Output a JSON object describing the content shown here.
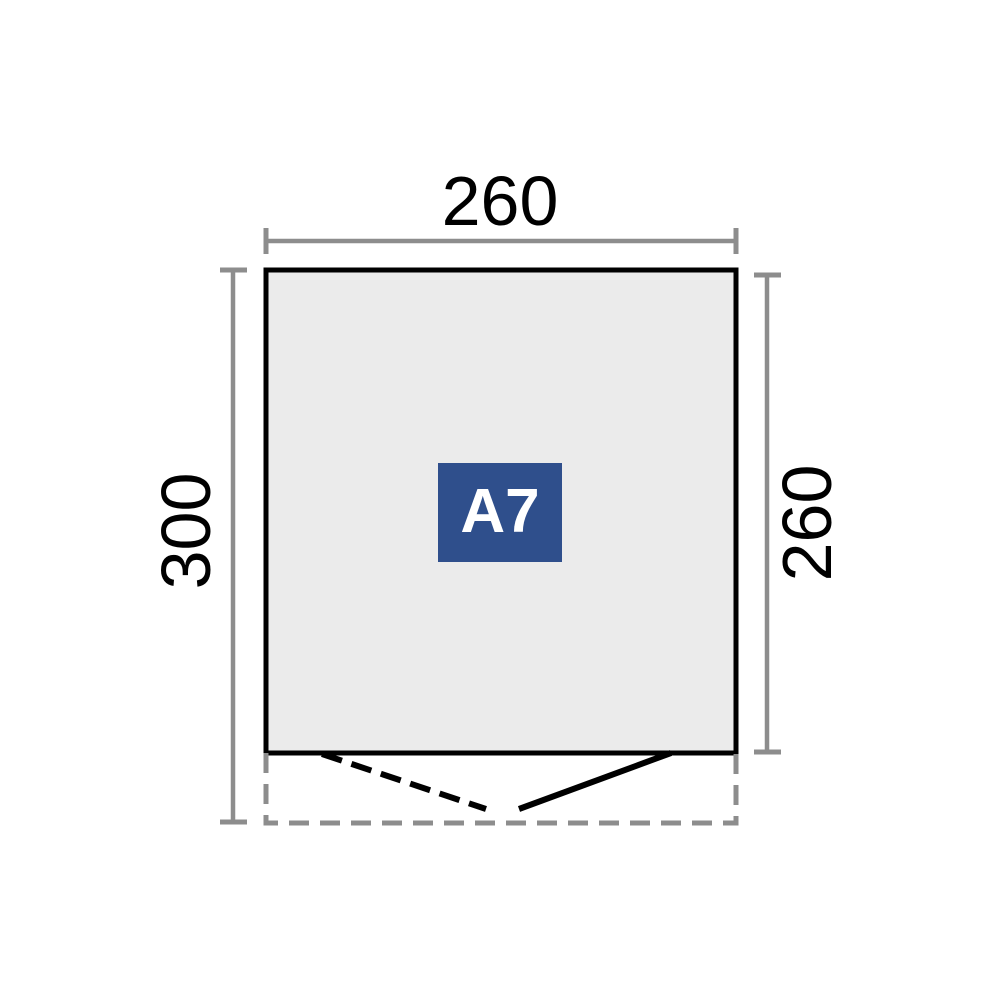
{
  "diagram": {
    "title": "shed-floor-plan",
    "model": "A7",
    "dimensions": {
      "width": "260",
      "total_depth": "300",
      "inner_depth": "260"
    },
    "colors": {
      "badge_bg": "#2f4f8c",
      "badge_text": "#ffffff",
      "floor_fill": "#ebebeb",
      "outline": "#000000",
      "dimension_gray": "#8d8d8d"
    }
  }
}
